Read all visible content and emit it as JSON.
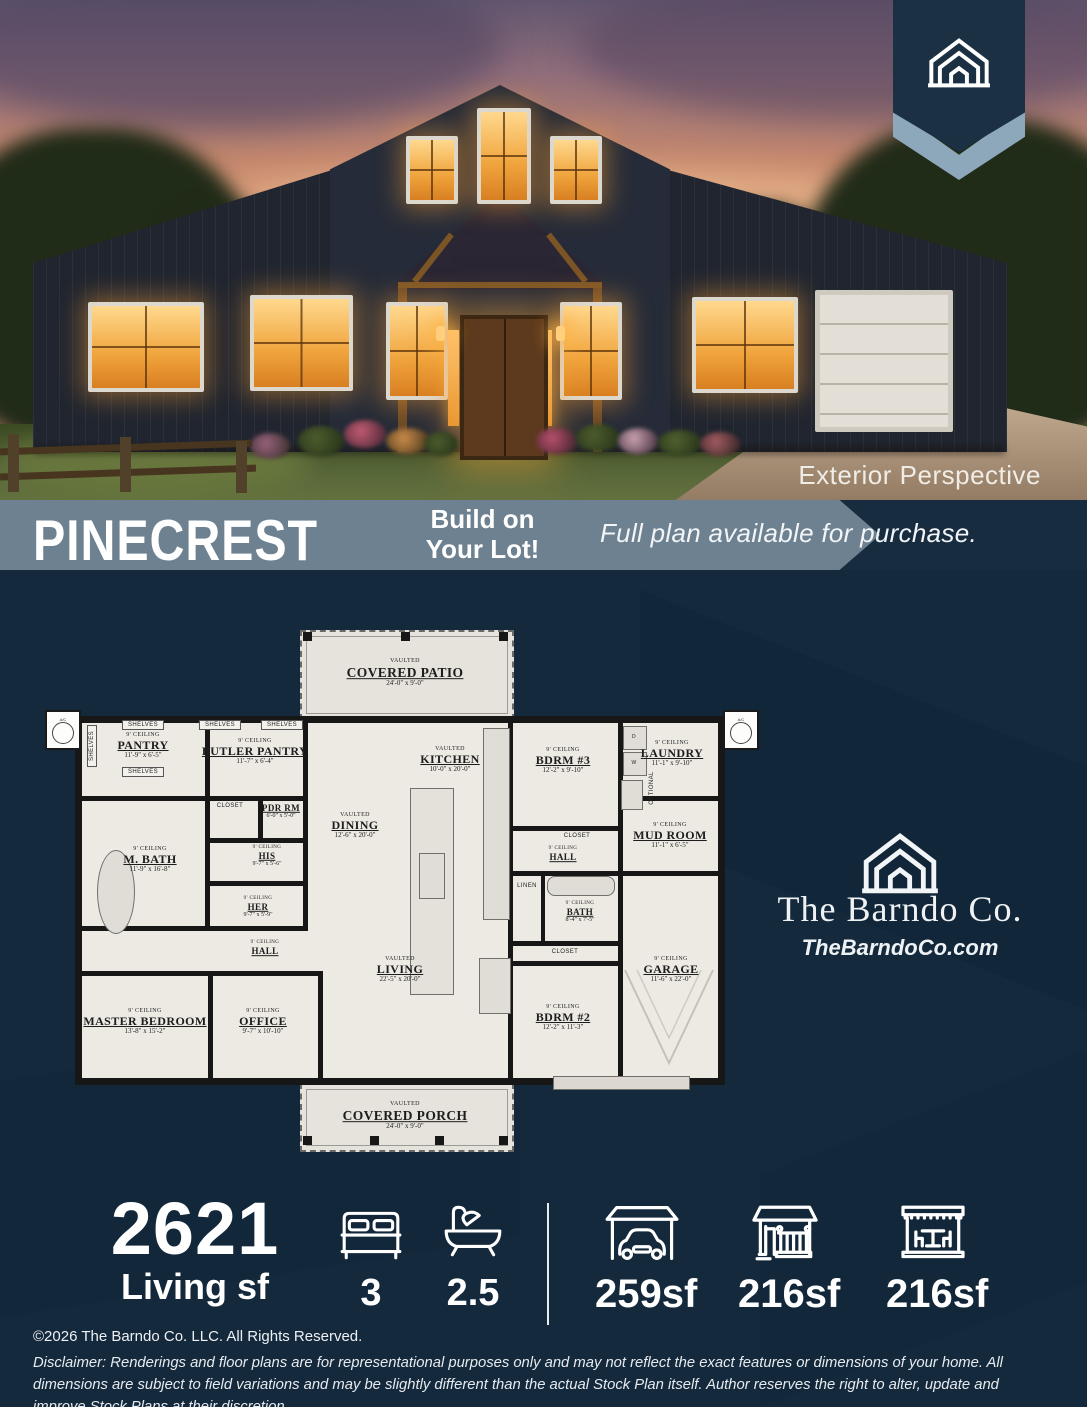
{
  "colors": {
    "navy": "#14293c",
    "banner_slate": "#6d8191",
    "badge_navy": "#1c3044",
    "badge_chevron": "#8ea8bb",
    "plan_paper": "#edeae4",
    "window_amber": "#f0a43c"
  },
  "hero": {
    "caption": "Exterior Perspective"
  },
  "banner": {
    "plan_name": "PINECREST",
    "build_line1": "Build on",
    "build_line2": "Your Lot!",
    "availability": "Full plan available for purchase."
  },
  "brand": {
    "name": "The Barndo Co.",
    "website": "TheBarndoCo.com"
  },
  "floor_plan": {
    "rooms": [
      {
        "name": "COVERED PATIO",
        "ceiling": "VAULTED",
        "dims": "24'-0\" x 9'-0\""
      },
      {
        "name": "PANTRY",
        "ceiling": "9' CEILING",
        "dims": "11'-9\" x 6'-5\""
      },
      {
        "name": "BUTLER PANTRY",
        "ceiling": "9' CEILING",
        "dims": "11'-7\" x 6'-4\""
      },
      {
        "name": "PDR RM",
        "ceiling": "8' CEILING",
        "dims": "6'-0\" x 5'-0\""
      },
      {
        "name": "KITCHEN",
        "ceiling": "VAULTED",
        "dims": "10'-0\" x 20'-0\""
      },
      {
        "name": "DINING",
        "ceiling": "VAULTED",
        "dims": "12'-6\" x 20'-0\""
      },
      {
        "name": "BDRM #3",
        "ceiling": "9' CEILING",
        "dims": "12'-2\" x 9'-10\""
      },
      {
        "name": "LAUNDRY",
        "ceiling": "9' CEILING",
        "dims": "11'-1\" x 9'-10\""
      },
      {
        "name": "MUD ROOM",
        "ceiling": "9' CEILING",
        "dims": "11'-1\" x 6'-5\""
      },
      {
        "name": "M. BATH",
        "ceiling": "9' CEILING",
        "dims": "11'-9\" x 16'-8\""
      },
      {
        "name": "HIS",
        "ceiling": "9' CEILING",
        "dims": "9'-7\" x 5'-6\""
      },
      {
        "name": "HER",
        "ceiling": "9' CEILING",
        "dims": "9'-7\" x 5'-9\""
      },
      {
        "name": "HALL",
        "ceiling": "9' CEILING",
        "dims": ""
      },
      {
        "name": "HALL",
        "ceiling": "9' CEILING",
        "dims": ""
      },
      {
        "name": "BATH",
        "ceiling": "9' CEILING",
        "dims": "8'-4\" x 7'-5\""
      },
      {
        "name": "LIVING",
        "ceiling": "VAULTED",
        "dims": "22'-5\" x 20'-0\""
      },
      {
        "name": "MASTER BEDROOM",
        "ceiling": "9' CEILING",
        "dims": "13'-8\" x 15'-2\""
      },
      {
        "name": "OFFICE",
        "ceiling": "9' CEILING",
        "dims": "9'-7\" x 10'-10\""
      },
      {
        "name": "BDRM #2",
        "ceiling": "9' CEILING",
        "dims": "12'-2\" x 11'-3\""
      },
      {
        "name": "GARAGE",
        "ceiling": "9' CEILING",
        "dims": "11'-6\" x 22'-0\""
      },
      {
        "name": "COVERED PORCH",
        "ceiling": "VAULTED",
        "dims": "24'-0\" x 9'-0\""
      }
    ],
    "labels": {
      "shelves": "SHELVES",
      "closet": "CLOSET",
      "linen": "LINEN",
      "optional": "OPTIONAL",
      "attic": "ATTIC ACCESS",
      "washer": "W",
      "dryer": "D",
      "ac": "A/C"
    }
  },
  "stats": {
    "living_sf": "2621",
    "living_label": "Living sf",
    "beds": "3",
    "baths": "2.5",
    "garage_sf": "259sf",
    "porch_sf": "216sf",
    "patio_sf": "216sf"
  },
  "footer": {
    "copyright": "©2026 The Barndo Co. LLC. All Rights Reserved.",
    "disclaimer": "Disclaimer: Renderings and floor plans are for representational purposes only and may not reflect the exact features or dimensions of your home. All dimensions are subject to field variations and may be slightly different than the actual Stock Plan itself. Author reserves the right to alter, update and improve Stock Plans at their discretion."
  }
}
